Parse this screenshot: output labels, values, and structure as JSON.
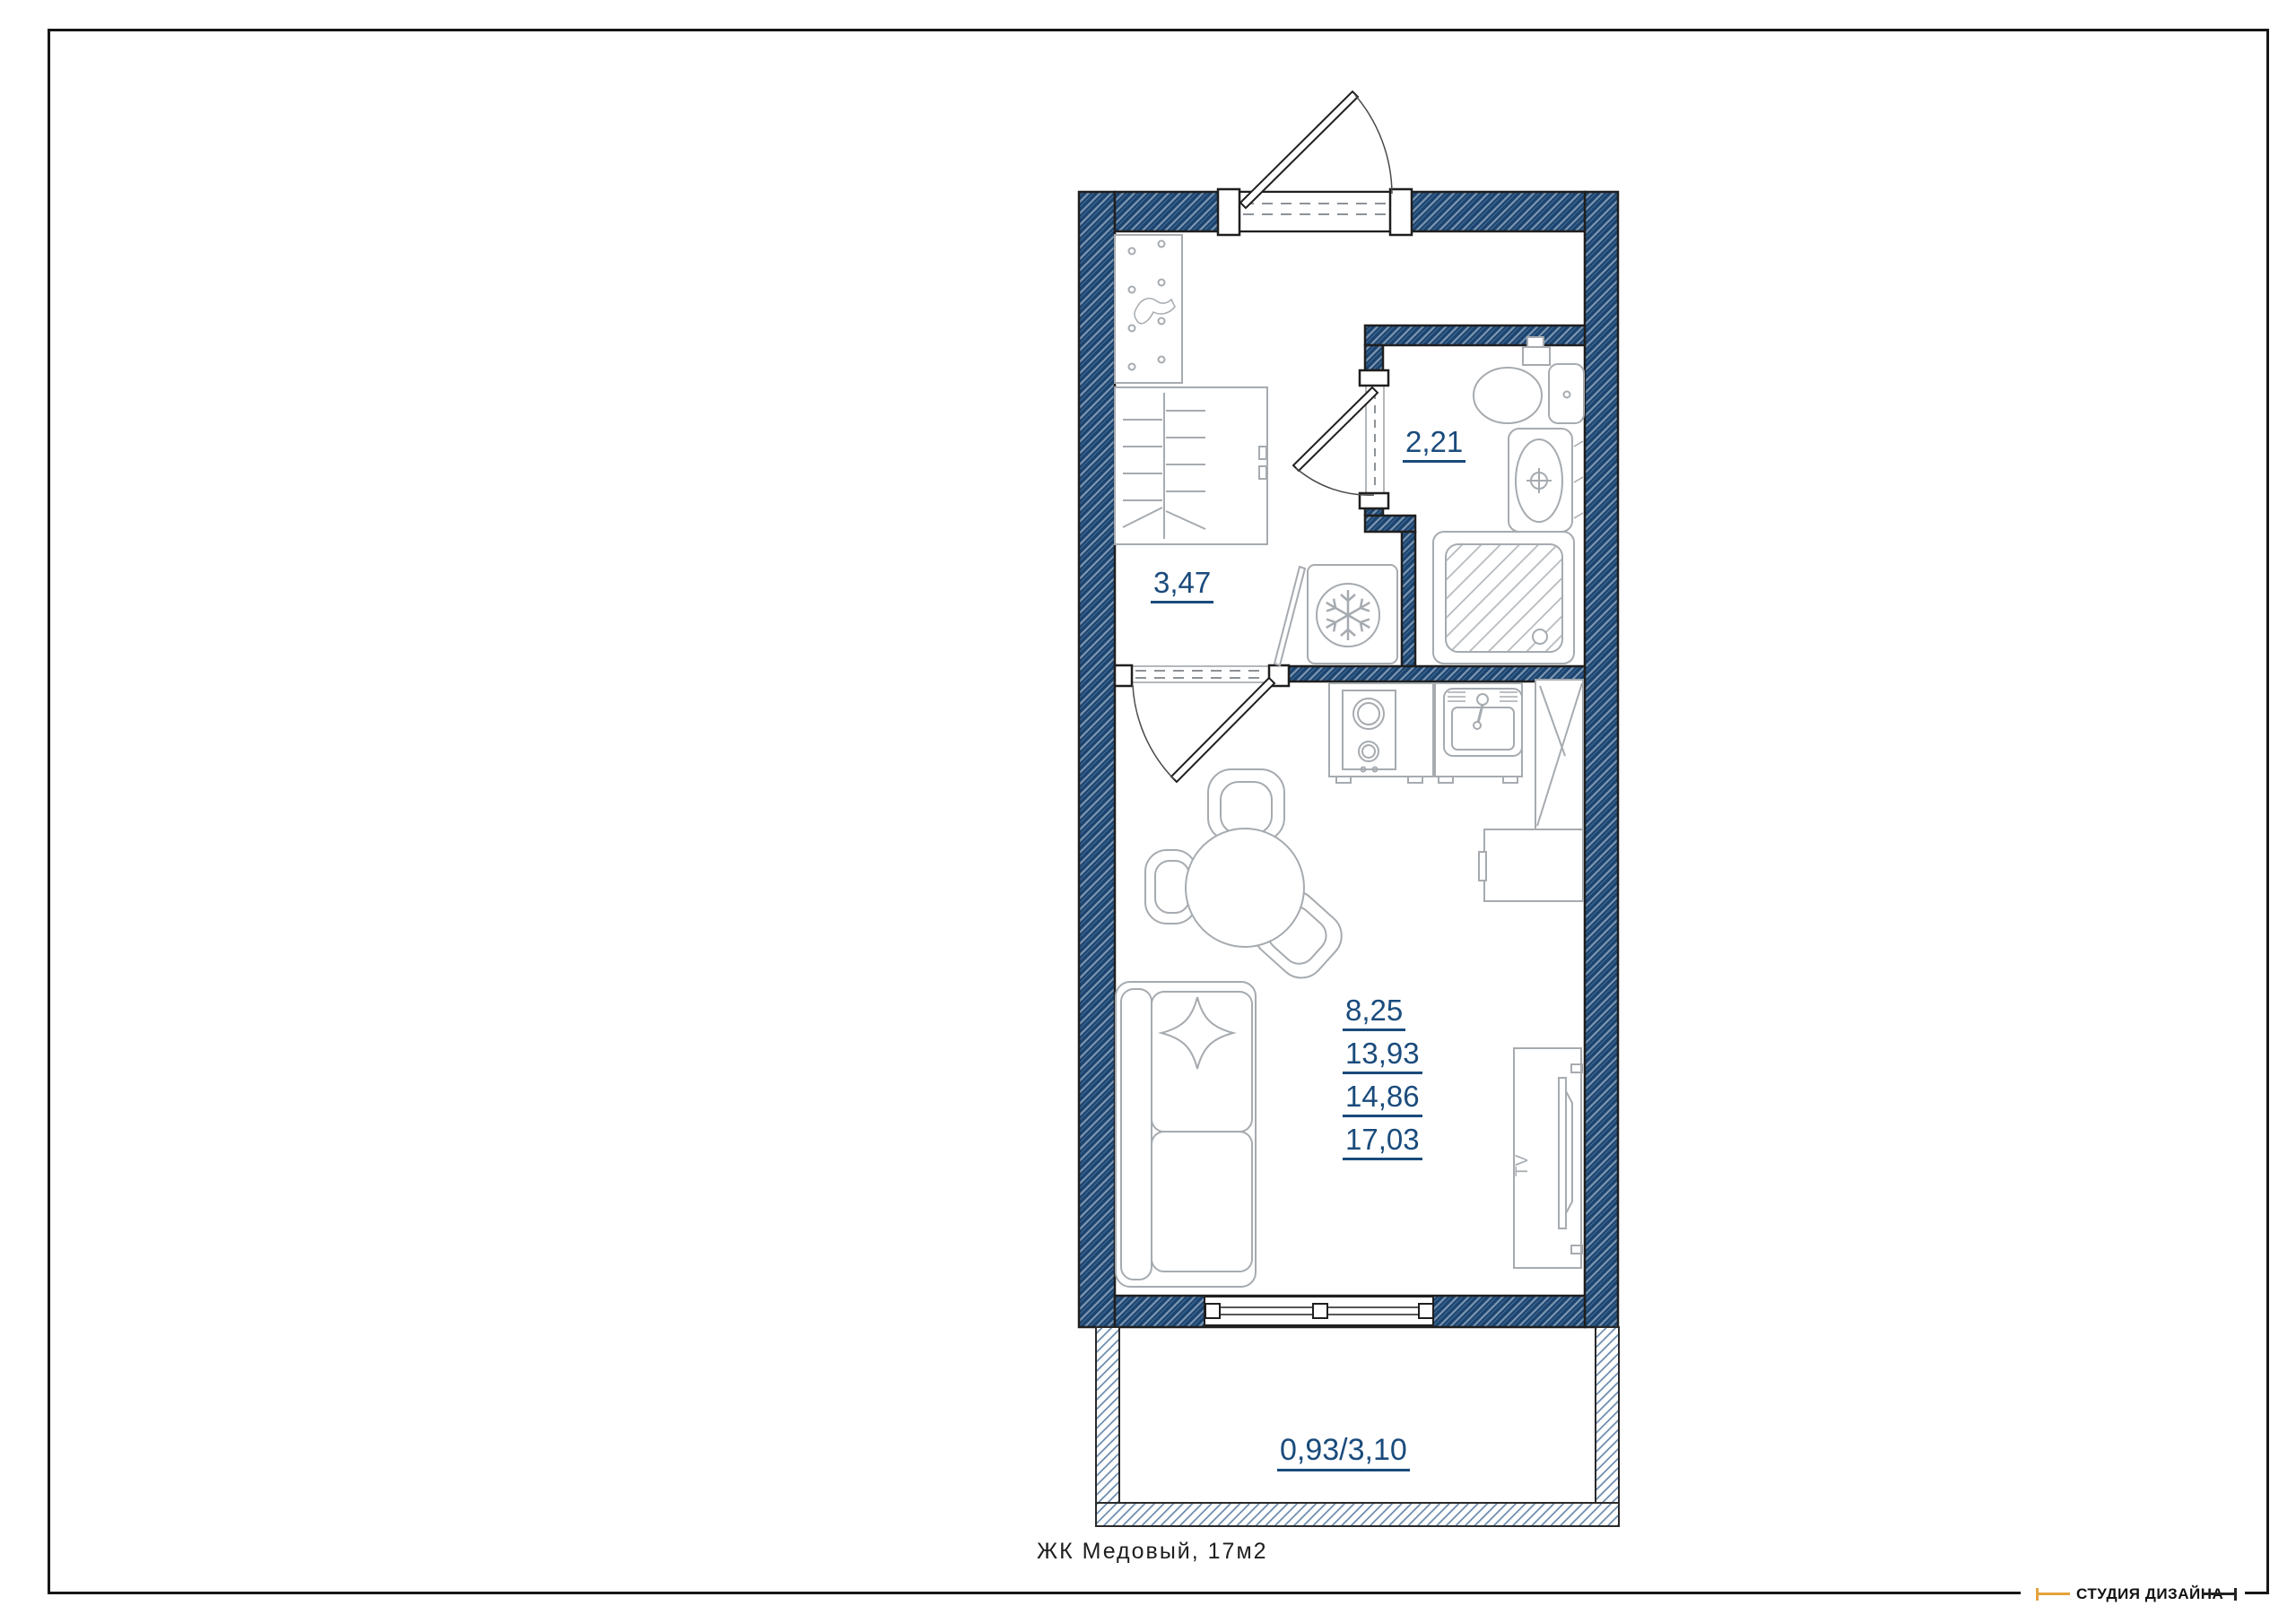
{
  "page": {
    "caption": "ЖК Медовый, 17м2"
  },
  "rooms": {
    "hall": {
      "label": "3,47"
    },
    "bathroom": {
      "label": "2,21"
    },
    "living": {
      "labels": [
        "8,25",
        "13,93",
        "14,86",
        "17,03"
      ]
    },
    "balcony": {
      "label": "0,93/3,10"
    }
  },
  "tv": {
    "label": "TV"
  },
  "footer": {
    "studio": "СТУДИЯ ДИЗАЙНА"
  },
  "colors": {
    "wall": "#1c4470",
    "balcony_hatch": "#346092",
    "room_label": "#1a4b7c",
    "furniture_outline": "#a6abb0",
    "accent_orange": "#e5a33c",
    "frame": "#161616"
  }
}
